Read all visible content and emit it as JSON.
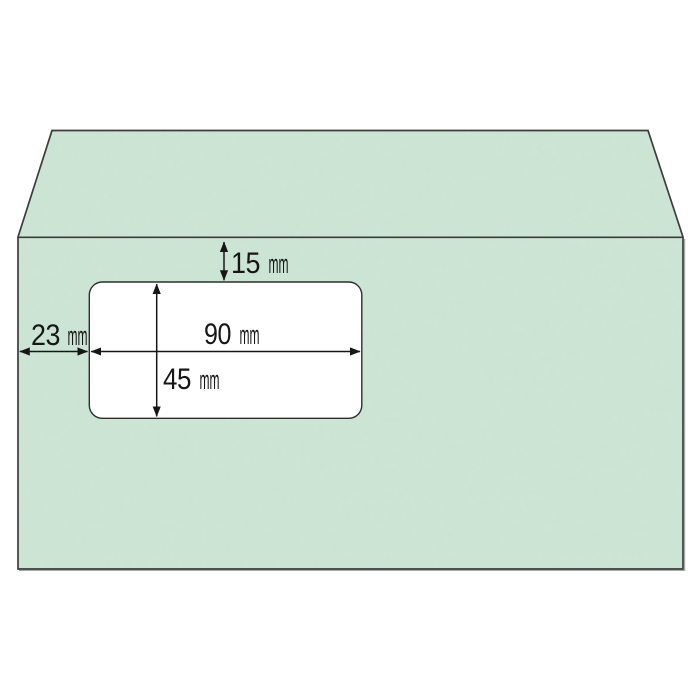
{
  "diagram": {
    "subject": "window-envelope-dimension-diagram",
    "units": "mm",
    "colors": {
      "envelope_green": "#cbe4d4",
      "envelope_outline": "#3c3c3c",
      "edge_shadow": "#8f9791",
      "window_white": "#ffffff",
      "window_outline": "#2e2e2e",
      "annotation_black": "#161616",
      "background": "#ffffff"
    },
    "window_spec": {
      "width_mm": 90,
      "height_mm": 45,
      "offset_from_top_mm": 15,
      "offset_from_left_mm": 23
    },
    "labels": {
      "top_margin": {
        "value": "15",
        "unit": "mm"
      },
      "left_margin": {
        "value": "23",
        "unit": "mm"
      },
      "window_width": {
        "value": "90",
        "unit": "mm"
      },
      "window_height": {
        "value": "45",
        "unit": "mm"
      }
    }
  }
}
